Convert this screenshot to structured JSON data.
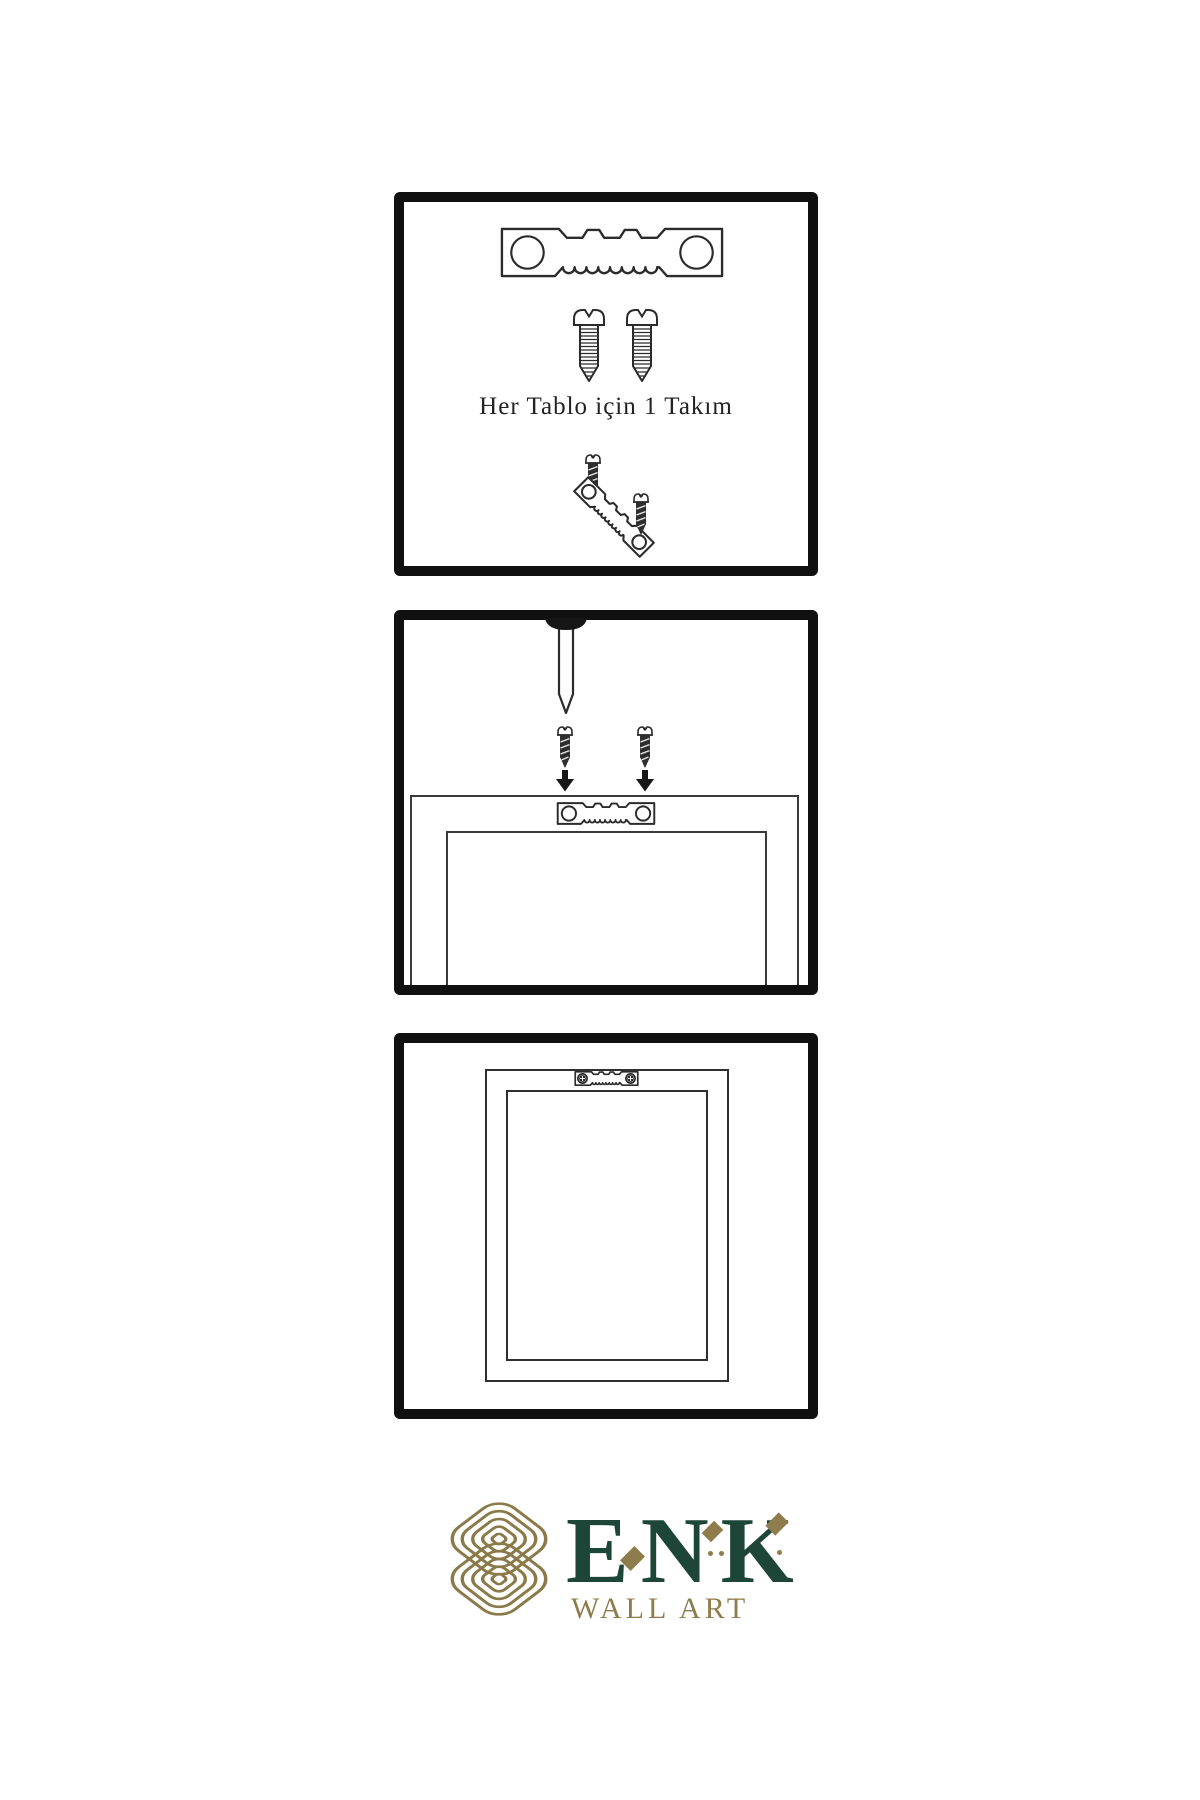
{
  "instruction_sheet": {
    "caption": "Her Tablo için 1 Takım",
    "steps": [
      {
        "name": "hardware-kit",
        "items": [
          "sawtooth-hanger",
          "screw",
          "screw",
          "mini-screw",
          "angled-sawtooth-hanger",
          "mini-screw"
        ]
      },
      {
        "name": "mark-wall",
        "items": [
          "nail",
          "mini-screw",
          "mini-screw",
          "arrow-down",
          "arrow-down",
          "sawtooth-hanger-on-frame",
          "picture-frame"
        ]
      },
      {
        "name": "hang-frame",
        "items": [
          "picture-frame",
          "sawtooth-hanger-with-screws"
        ]
      }
    ]
  },
  "logo": {
    "brand": "ENK",
    "tagline": "WALL ART"
  },
  "colors": {
    "background": "#ffffff",
    "outline": "#2b2b2b",
    "panel_border": "#101010",
    "metal_dark": "#2e2e2e",
    "brand_green": "#1d4538",
    "brand_gold": "#8e7c4c"
  }
}
